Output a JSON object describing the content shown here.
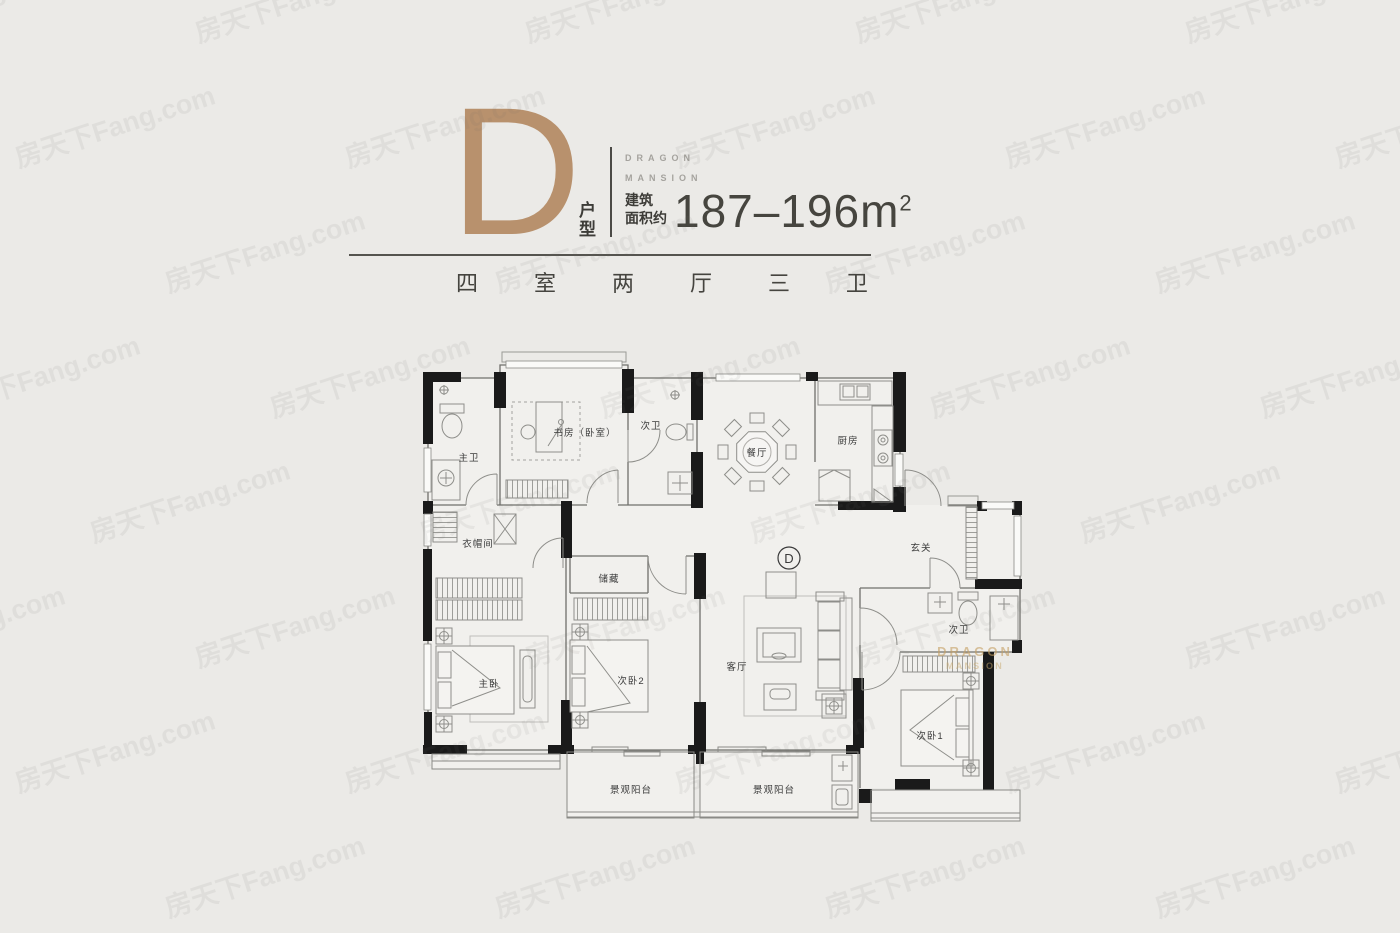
{
  "header": {
    "letter": "D",
    "unit_label": "户型",
    "brand_line1": "DRAGON",
    "brand_line2": "MANSION",
    "area_prefix_line1": "建筑",
    "area_prefix_line2": "面积约",
    "area_range": "187–196m",
    "area_sup": "2",
    "spec_chars": [
      "四",
      "室",
      "两",
      "厅",
      "三",
      "卫"
    ]
  },
  "plan": {
    "badge": "D",
    "rooms": {
      "master_bath": "主卫",
      "study": "书房（卧室）",
      "bath2": "次卫",
      "dining": "餐厅",
      "kitchen": "厨房",
      "foyer": "玄关",
      "cloak": "衣帽间",
      "storage": "储藏",
      "master_bed": "主卧",
      "bed2": "次卧2",
      "living": "客厅",
      "bath3": "次卫",
      "bed1": "次卧1",
      "balcony1": "景观阳台",
      "balcony2": "景观阳台"
    },
    "brand_line1": "DRAGON",
    "brand_line2": "MANSION"
  },
  "watermark": {
    "text": "房天下Fang.com"
  }
}
